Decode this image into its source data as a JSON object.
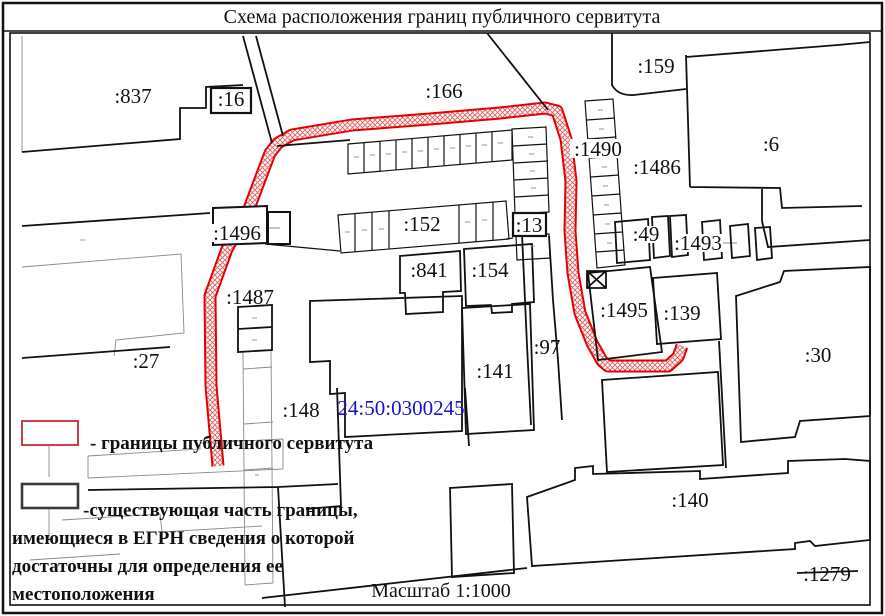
{
  "title": "Схема расположения границ публичного сервитута",
  "scale_label": "Масштаб 1:1000",
  "cadastral_quarter": "24:50:0300245",
  "parcels": {
    "p837": ":837",
    "p16": ":16",
    "p166": ":166",
    "p159": ":159",
    "p6": ":6",
    "p1490": ":1490",
    "p1486": ":1486",
    "p49": ":49",
    "p1493": ":1493",
    "p1496": ":1496",
    "p152": ":152",
    "p13": ":13",
    "p841": ":841",
    "p154": ":154",
    "p1487": ":1487",
    "p97": ":97",
    "p141": ":141",
    "p27": ":27",
    "p148": ":148",
    "p1495": ":1495",
    "p139": ":139",
    "p30": ":30",
    "p140": ":140",
    "p1279": ":1279"
  },
  "legend": {
    "servitude_label": "- границы публичного сервитута",
    "existing_boundary_lines": [
      "-существующая часть границы,",
      "имеющиеся в ЕГРН сведения о которой",
      "достаточны для определения ее",
      "местоположения"
    ],
    "servitude_color": "#e60000",
    "existing_color": "#3a3a3a"
  },
  "colors": {
    "servitude_red": "#e60000",
    "legend_swatch_red": "#c8404a",
    "cadastral_blue": "#1414cc",
    "boundary_black": "#111111",
    "detail_gray": "#8a8a8a"
  }
}
